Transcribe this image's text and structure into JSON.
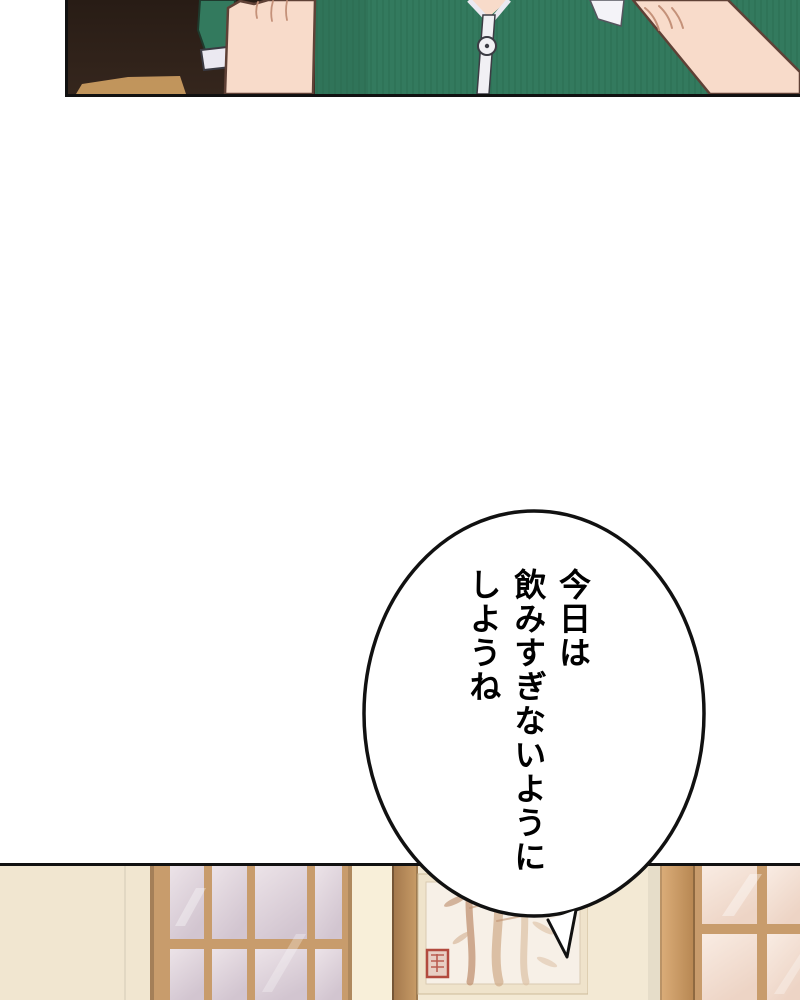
{
  "page": {
    "width": 800,
    "height": 1000,
    "background": "#ffffff"
  },
  "speech_bubble": {
    "lines": [
      "今日は",
      "飲みすぎないように",
      "しようね"
    ],
    "full_text": "今日は 飲みすぎないように しようね"
  },
  "palette": {
    "ink": "#111111",
    "shirt_green": "#337a5e",
    "shirt_green_shade": "#2a6a50",
    "skin": "#f8dbca",
    "skin_line": "#5f4136",
    "crease": "#c49179",
    "dark_room": "#35261d",
    "dark_room_top": "#281c15",
    "light_wedge": "#c99b60",
    "cuff_white": "#ebe9f1",
    "zipper_white": "#f1f0f4",
    "wall_cream": "#f3e9d4",
    "wall_left": "#f1e6d0",
    "wall_light": "#f8efd9",
    "wood_tan": "#c89c6c",
    "pillar_dark": "#a1764b",
    "pillar_light": "#c99d68",
    "post_light": "#dcae7a",
    "post_dark": "#b68651",
    "pane_lav_1": "#ece3e8",
    "pane_lav_2": "#d2c5d0",
    "pane_pink_1": "#f9ece3",
    "pane_pink_2": "#edd4c5",
    "mat_cream": "#efe3cb",
    "painting_bg": "#f7f0e7",
    "bamboo_1": "#c09272",
    "bamboo_2": "#cfa988",
    "bamboo_3": "#dcc0a4",
    "seal_red": "#b24a3e"
  }
}
